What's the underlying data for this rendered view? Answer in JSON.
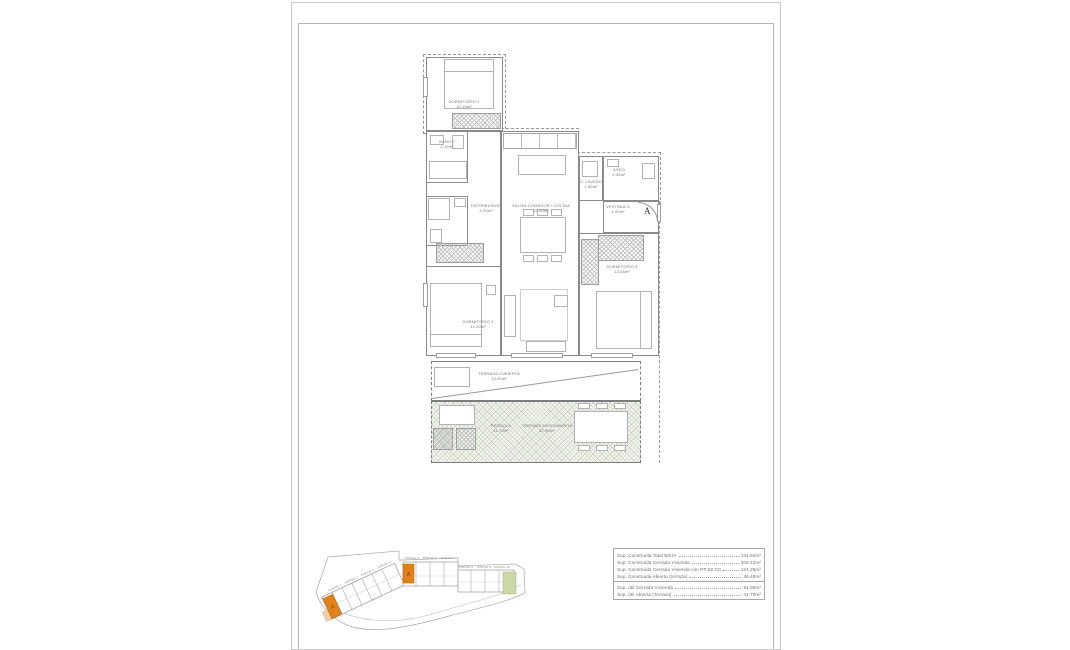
{
  "floor_plan": {
    "rooms": [
      {
        "name": "DORMITORIO 2",
        "area": "10.15m²"
      },
      {
        "name": "BAÑO 2",
        "area": "4.15m²"
      },
      {
        "name": "DISTRIBUIDOR",
        "area": "3.20m²"
      },
      {
        "name": "SALÓN-COMEDOR / COCINA",
        "area": "26.60m²"
      },
      {
        "name": "C. LAVADO",
        "area": "1.86m²"
      },
      {
        "name": "ASEO",
        "area": "2.35m²"
      },
      {
        "name": "VESTÍBULO",
        "area": "4.95m²"
      },
      {
        "name": "DORMITORIO 3",
        "area": "12.08m²"
      },
      {
        "name": "DORMITORIO 1",
        "area": "14.30m²"
      },
      {
        "name": "TERRAZA CUBIERTA",
        "area": "13.90m²"
      },
      {
        "name": "PÉRGOLA",
        "area": "41.70m²"
      },
      {
        "name": "TERRAZA DESCUBIERTA",
        "area": "37.80m²"
      }
    ],
    "section_marker": "A"
  },
  "site_plan": {
    "portals": [
      "PORTAL 1",
      "PORTAL 2",
      "PORTAL 3",
      "PORTAL 4",
      "PORTAL 5",
      "PORTAL 6",
      "PORTAL 7",
      "PORTAL 8",
      "PORTAL 9",
      "PORTAL 10"
    ],
    "unit_marker": "A",
    "colors": {
      "highlight": "#E2801A",
      "highlight_light": "#F3CDA6",
      "green": "#CBD7A5"
    }
  },
  "areas_table": {
    "rows": [
      {
        "label": "Sup. Construida Total BOJA",
        "value": "134.84m²"
      },
      {
        "label": "Sup. Construida Cerrada Vivienda",
        "value": "106.42m²"
      },
      {
        "label": "Sup. Construida Cerrada Vivienda con PP.ZZ.CC",
        "value": "124.25m²"
      },
      {
        "label": "Sup. Construida Abierta (terraza)",
        "value": "46.40m²"
      },
      {
        "label": "Sup. útil Cerrada Vivienda",
        "value": "91.80m²"
      },
      {
        "label": "Sup. útil Abierta (Terraza)",
        "value": "41.70m²"
      }
    ]
  }
}
